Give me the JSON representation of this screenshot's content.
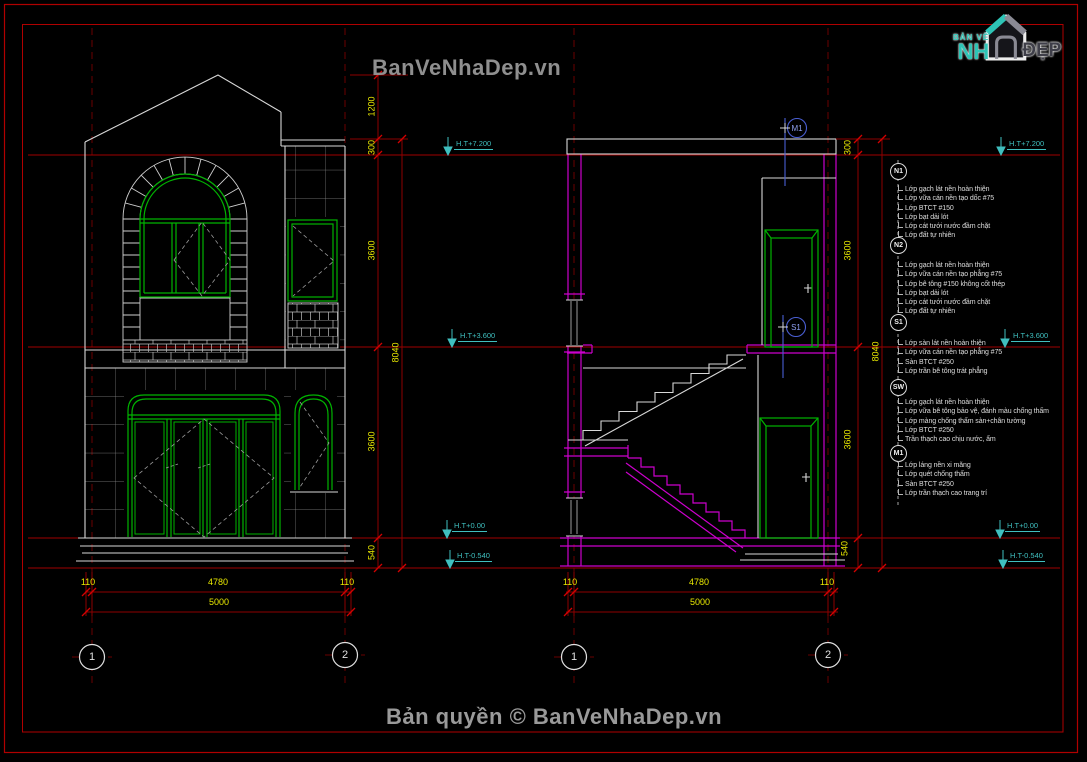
{
  "watermark_top": "BanVeNhaDep.vn",
  "copyright": "Bản quyền © BanVeNhaDep.vn",
  "logo": {
    "tagline": "BẢN VẼ",
    "nh": "NH",
    "dep": "ĐẸP"
  },
  "levels": [
    "H.T+7.200",
    "H.T+3.600",
    "H.T+0.00",
    "H.T-0.540"
  ],
  "elevation": {
    "vertical_dims": [
      "1200",
      "300",
      "3600",
      "3600",
      "540"
    ],
    "overall_dim": "8040",
    "bottom_dims": [
      "110",
      "4780",
      "110"
    ],
    "bottom_total": "5000",
    "axes": [
      "1",
      "2"
    ]
  },
  "section": {
    "vertical_dims": [
      "300",
      "3600",
      "3600",
      "540"
    ],
    "overall_dim": "8040",
    "bottom_dims": [
      "110",
      "4780",
      "110"
    ],
    "bottom_total": "5000",
    "axes": [
      "1",
      "2"
    ],
    "callouts": [
      "M1",
      "S1"
    ]
  },
  "notes": [
    {
      "id": "N1",
      "lines": [
        "Lớp gạch lát nền hoàn thiện",
        "Lớp vữa cán nền tạo dốc #75",
        "Lớp BTCT #150",
        "Lớp bạt dải lót",
        "Lớp cát tưới nước đầm chặt",
        "Lớp đất tự nhiên"
      ]
    },
    {
      "id": "N2",
      "lines": [
        "Lớp gạch lát nền hoàn thiện",
        "Lớp vữa cán nền tạo phẳng #75",
        "Lớp bê tông #150 không cốt thép",
        "Lớp bạt dải lót",
        "Lớp cát tưới nước đầm chặt",
        "Lớp đất tự nhiên"
      ]
    },
    {
      "id": "S1",
      "lines": [
        "Lớp sàn lát nền hoàn thiện",
        "Lớp vữa cán nền tạo phẳng #75",
        "Sàn BTCT #250",
        "Lớp trần bê tông trát phẳng"
      ]
    },
    {
      "id": "SW",
      "lines": [
        "Lớp gạch lát nền hoàn thiện",
        "Lớp vữa bê tông bảo vệ, đánh màu chống thấm",
        "Lớp màng chống thấm sàn+chân tường",
        "Lớp BTCT #250",
        "Trần thạch cao chịu nước, ẩm"
      ]
    },
    {
      "id": "M1",
      "lines": [
        "Lớp láng nền xi măng",
        "Lớp quét chống thấm",
        "Sàn BTCT #250",
        "Lớp trần thạch cao trang trí"
      ]
    }
  ],
  "colors": {
    "background": "#000000",
    "border_red": "#b00000",
    "level_line_red": "#a00000",
    "dim_yellow": "#e8e800",
    "level_cyan": "#3fbfbf",
    "frame_green": "#00b400",
    "section_magenta": "#cc00cc",
    "line_white": "#d8d8d8",
    "callout_blue": "#4a5fd4",
    "logo_teal": "#2ec4b6",
    "watermark_gray": "#8f8f8f"
  }
}
